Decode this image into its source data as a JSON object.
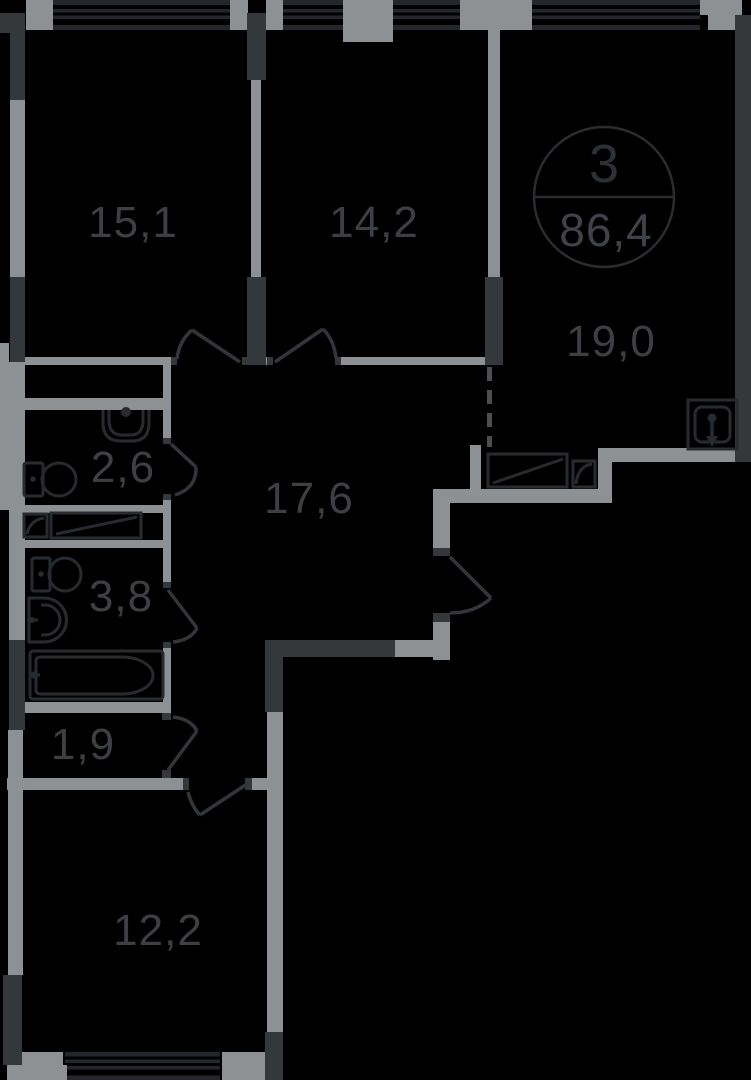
{
  "floor_plan": {
    "badge": {
      "number": "3",
      "area": "86,4"
    },
    "rooms": [
      {
        "label": "15,1"
      },
      {
        "label": "14,2"
      },
      {
        "label": "19,0"
      },
      {
        "label": "2,6"
      },
      {
        "label": "17,6"
      },
      {
        "label": "3,8"
      },
      {
        "label": "1,9"
      },
      {
        "label": "12,2"
      }
    ],
    "icons": [
      "sink-icon",
      "toilet-icon",
      "washing-machine-icon",
      "counter-icon",
      "round-sink-icon",
      "bathtub-icon",
      "kitchen-counter-icon",
      "kitchen-hob-icon",
      "kitchen-sink-icon",
      "door-arc-icon",
      "window-icon"
    ],
    "colors": {
      "background": "#000000",
      "wall_dark": "#35383b",
      "wall_light": "#8e9194",
      "window_stripe": "#23262a",
      "fixture_line": "#282b2e",
      "door_line": "#32363a",
      "dash_line": "#4b4f52",
      "label_text": "#3d4043",
      "badge_stroke": "#2a2d30"
    }
  }
}
